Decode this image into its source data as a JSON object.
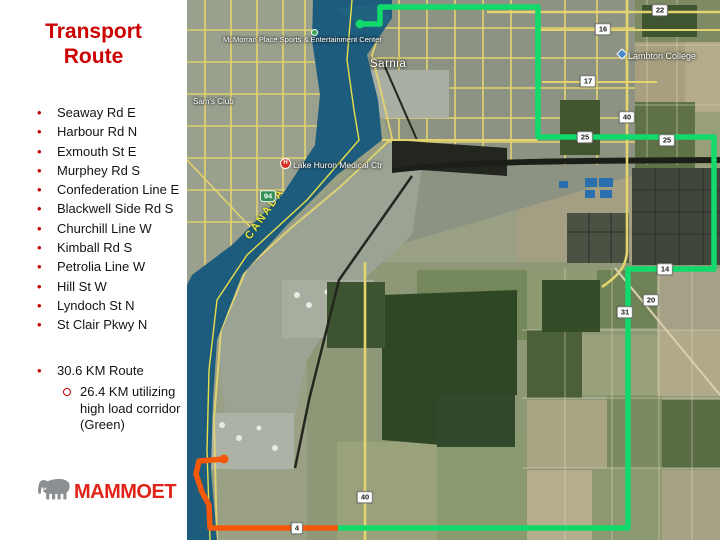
{
  "sidebar": {
    "title_line1": "Transport",
    "title_line2": "Route",
    "items": [
      "Seaway Rd E",
      "Harbour Rd N",
      "Exmouth St E",
      "Murphey Rd S",
      "Confederation Line E",
      "Blackwell Side Rd S",
      "Churchill Line W",
      "Kimball Rd S",
      "Petrolia Line W",
      "Hill St W",
      "Lyndoch St N",
      "St Clair Pkwy N"
    ],
    "route_summary": "30.6 KM Route",
    "route_detail": "26.4 KM utilizing high load corridor (Green)",
    "logo_text": "MAMMOET"
  },
  "map": {
    "labels": {
      "entertainment_center": "McMorran Place Sports & Entertainment Center",
      "city": "Sarnia",
      "sams_club": "Sam's Club",
      "college": "Lambton College",
      "hospital": "Lake Huron Medical Ctr",
      "hospital_pin": "H",
      "country": "CANADA"
    },
    "shields": [
      {
        "label": "22"
      },
      {
        "label": "16"
      },
      {
        "label": "17"
      },
      {
        "label": "40"
      },
      {
        "label": "25"
      },
      {
        "label": "25"
      },
      {
        "label": "14"
      },
      {
        "label": "20"
      },
      {
        "label": "31"
      },
      {
        "label": "40"
      },
      {
        "label": "4"
      },
      {
        "label": "94"
      }
    ],
    "colors": {
      "route_green": "#12d96b",
      "route_orange": "#f4590a",
      "river": "#1d5c7d",
      "border_line": "#e8e04a"
    }
  }
}
